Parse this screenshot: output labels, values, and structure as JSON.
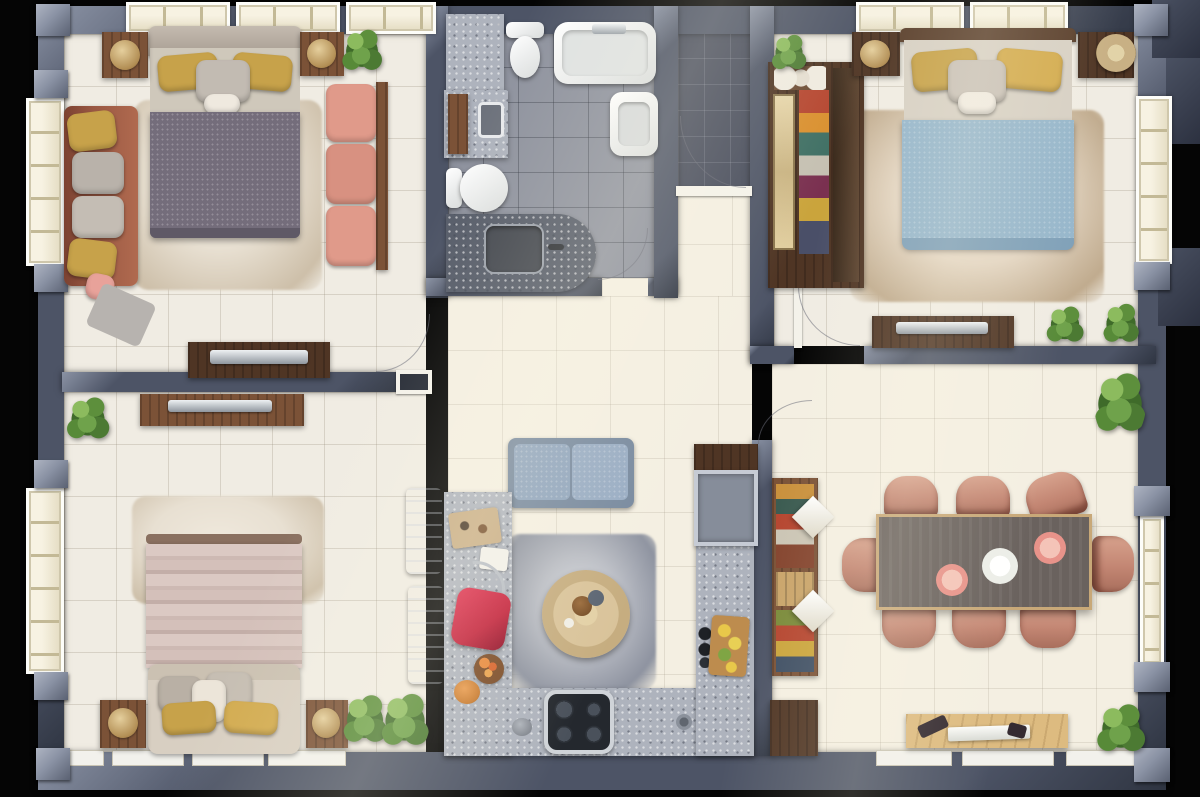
{
  "image_type": "3d-top-down-apartment-floor-plan-render",
  "title": "Three-bedroom apartment floor plan",
  "visible_text": [],
  "colors": {
    "wall": "#4d5466",
    "wall-hi": "#8a92a4",
    "wall-dk": "#2f3542",
    "floor": "#f0ece3",
    "floor-cream": "#f4efe2",
    "bath-floor": "#8e929e",
    "entry-floor": "#474c5c",
    "granite": "#aeb3bd",
    "granite-dark": "#565c69",
    "wood-dark": "#4f3524",
    "wood": "#7b5237",
    "wood-light": "#c9a46a",
    "wood-pale": "#ddbb80",
    "bed1-duvet": "#746d7b",
    "bed2-duvet": "#96b6cb",
    "bed3-stripe-a": "#dbc9c3",
    "bed3-stripe-b": "#c3aea8",
    "sofa-rust": "#9a5843",
    "sofa-pink": "#e09a8a",
    "sofa-blue": "#8fa4bd",
    "chair": "#c38673",
    "table-top": "#6a625e",
    "accent-red": "#c2203a",
    "pillow-yellow": "#c7a24a",
    "rug": "#e8e0d2",
    "gray-rug": "#b9bcc4",
    "plant-green": "#6fa24b",
    "plant-dark": "#4c7a33"
  },
  "rooms": [
    {
      "id": "bedroom-master",
      "position": "top-left",
      "furniture": [
        "double-bed-gray-duvet",
        "yellow-pillows",
        "area-rug",
        "rust-sofa",
        "pink-sofa",
        "wood-bench",
        "nightstand-left",
        "nightstand-right",
        "decor-bowls",
        "plant",
        "tv-console",
        "pink-pouf",
        "gray-throw"
      ]
    },
    {
      "id": "bathroom",
      "position": "top-center",
      "furniture": [
        "bathtub",
        "toilet-top",
        "toilet-left",
        "vanity-counter",
        "vanity-sink",
        "wall-sink",
        "corner-vanity-dark-granite",
        "door-swing"
      ]
    },
    {
      "id": "entry-vestibule",
      "position": "top-center-right",
      "furniture": [
        "dark-tile-floor",
        "entry-door-swing"
      ]
    },
    {
      "id": "bedroom-2",
      "position": "top-right",
      "furniture": [
        "double-bed-blue-duvet",
        "yellow-pillows",
        "beige-rug",
        "open-wardrobe-colorful",
        "mirror-door",
        "towel-shelf",
        "nightstand-left",
        "nightstand-right",
        "rattan-basket-chair",
        "tv-console",
        "plants"
      ]
    },
    {
      "id": "bedroom-3",
      "position": "bottom-left",
      "furniture": [
        "double-bed-striped-duvet",
        "upholstered-foot-bench",
        "yellow-pillows",
        "marble-rug",
        "nightstand-left",
        "nightstand-right",
        "media-console",
        "plants",
        "bar-stools"
      ]
    },
    {
      "id": "kitchen-living",
      "position": "bottom-center",
      "furniture": [
        "blue-loveseat",
        "round-wood-coffee-table",
        "gray-area-rug",
        "u-shaped-granite-counter",
        "fridge",
        "cooktop-stove",
        "sink-faucet",
        "cutting-boards",
        "red-cushion",
        "fruit-bowl",
        "orange-pot",
        "lemon-board",
        "plant"
      ]
    },
    {
      "id": "dining-room",
      "position": "bottom-right",
      "furniture": [
        "dining-table-8-seats",
        "pink-dining-chairs",
        "dinner-plates",
        "buffet-hutch-colorful",
        "napkin-decor",
        "low-cabinet",
        "sideboard-with-tray",
        "balcony-door",
        "plants"
      ]
    }
  ]
}
